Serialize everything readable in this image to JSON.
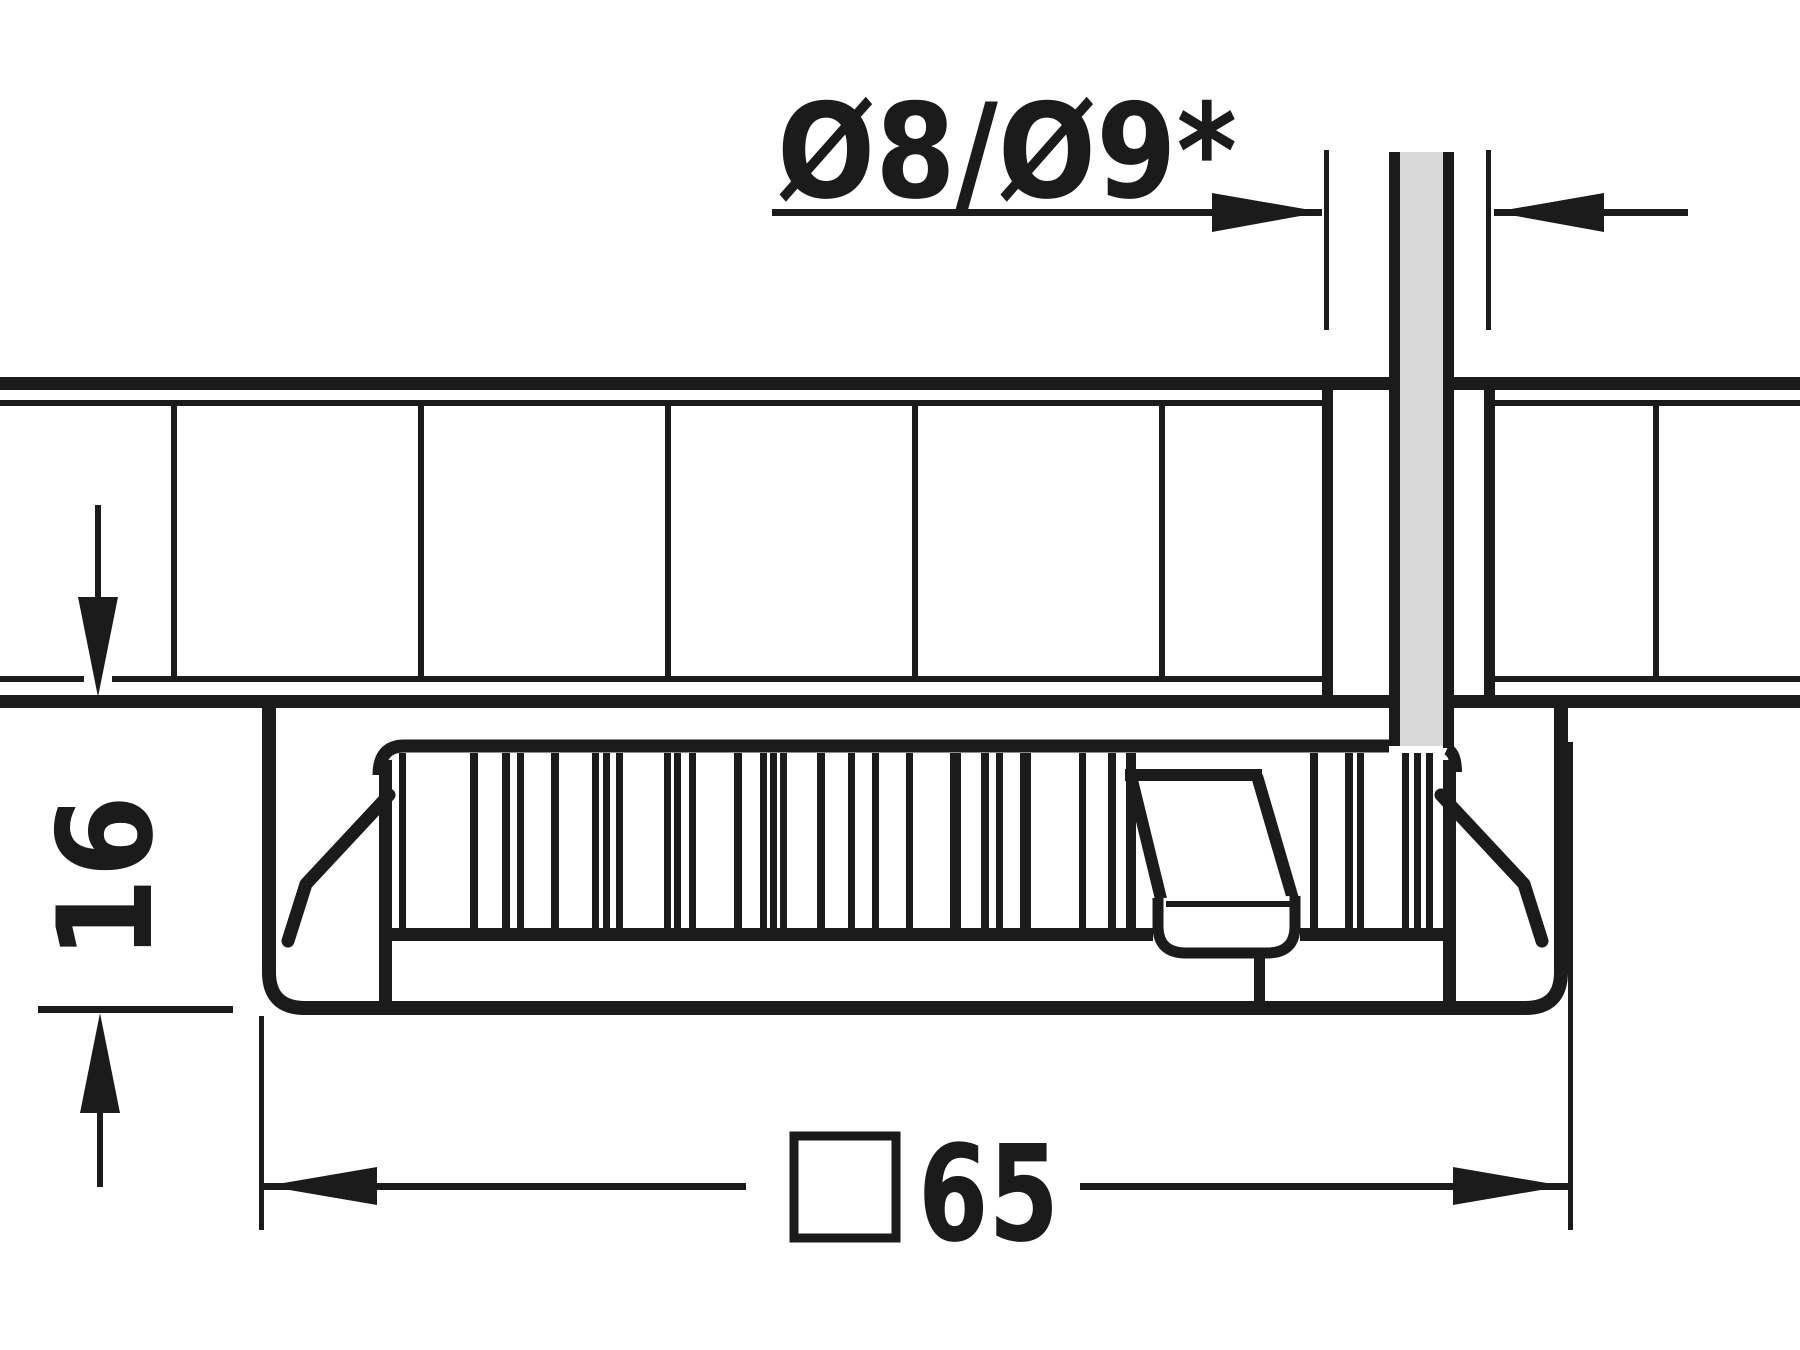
{
  "figure": {
    "type": "technical-installation-drawing",
    "description": "Side cross-section of a square recessed luminaire mounted under a 16 mm board with cable feed-through hole",
    "line_color": "#1b1b1b",
    "cable_fill_color": "#d9d9d9",
    "background_color": "#ffffff"
  },
  "dimensions": {
    "hole_diameter": {
      "label": "Ø8/Ø9*",
      "meaning": "cable feed-through drill hole diameter"
    },
    "mounting_depth": {
      "label": "16",
      "meaning": "depth of housing below board"
    },
    "housing_width": {
      "label": "65",
      "square_symbol": "□",
      "meaning": "square housing size"
    }
  }
}
